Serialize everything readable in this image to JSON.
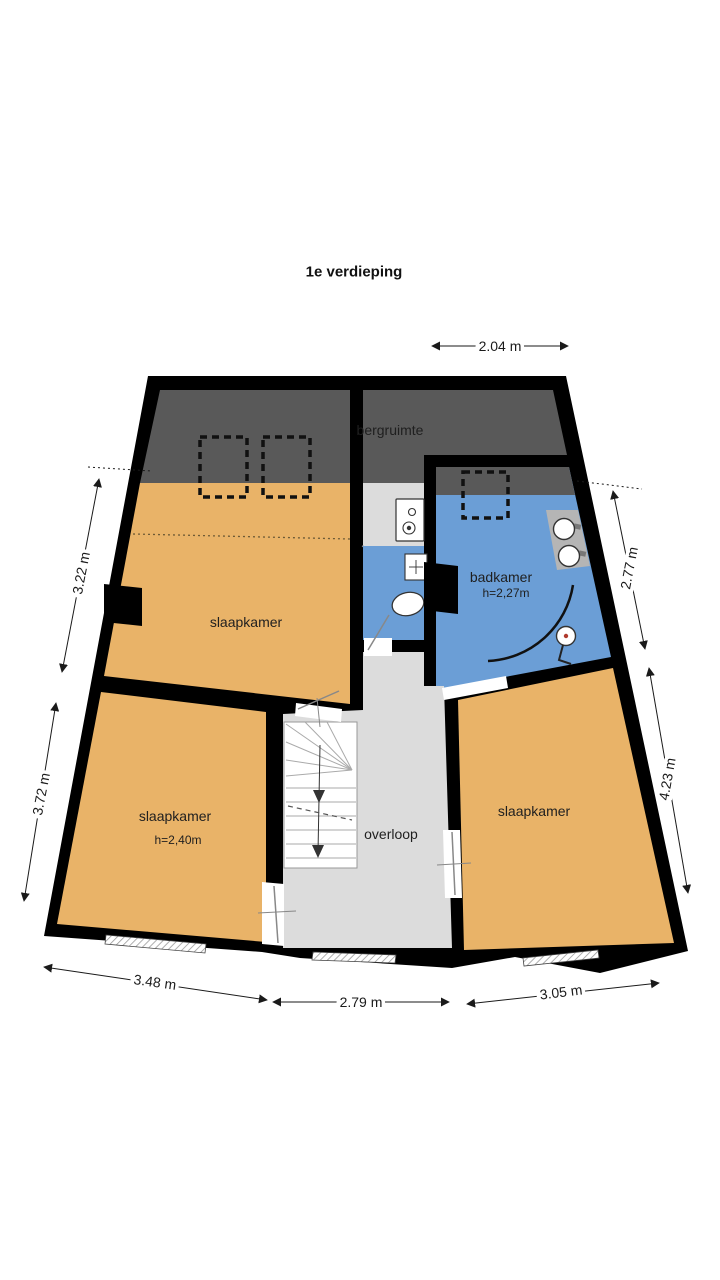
{
  "title": "1e verdieping",
  "rooms": {
    "slaapkamer_top": {
      "label": "slaapkamer"
    },
    "bergruimte": {
      "label": "bergruimte"
    },
    "badkamer": {
      "label": "badkamer",
      "height": "h=2,27m"
    },
    "slaapkamer_left": {
      "label": "slaapkamer",
      "height": "h=2,40m"
    },
    "slaapkamer_right": {
      "label": "slaapkamer"
    },
    "overloop": {
      "label": "overloop"
    }
  },
  "dimensions": {
    "top": "2.04 m",
    "left_upper": "3.22 m",
    "left_lower": "3.72 m",
    "right_upper": "2.77 m",
    "right_lower": "4.23 m",
    "bottom_left": "3.48 m",
    "bottom_middle": "2.79 m",
    "bottom_right": "3.05 m"
  },
  "colors": {
    "wall": "#000000",
    "bedroom_fill": "#e9b368",
    "bathroom_fill": "#6b9ed6",
    "low_ceiling_fill": "#595959",
    "floor_fill": "#dcdcdc",
    "counter_fill": "#b5b5b5",
    "dimension_color": "#1a1a1a"
  }
}
